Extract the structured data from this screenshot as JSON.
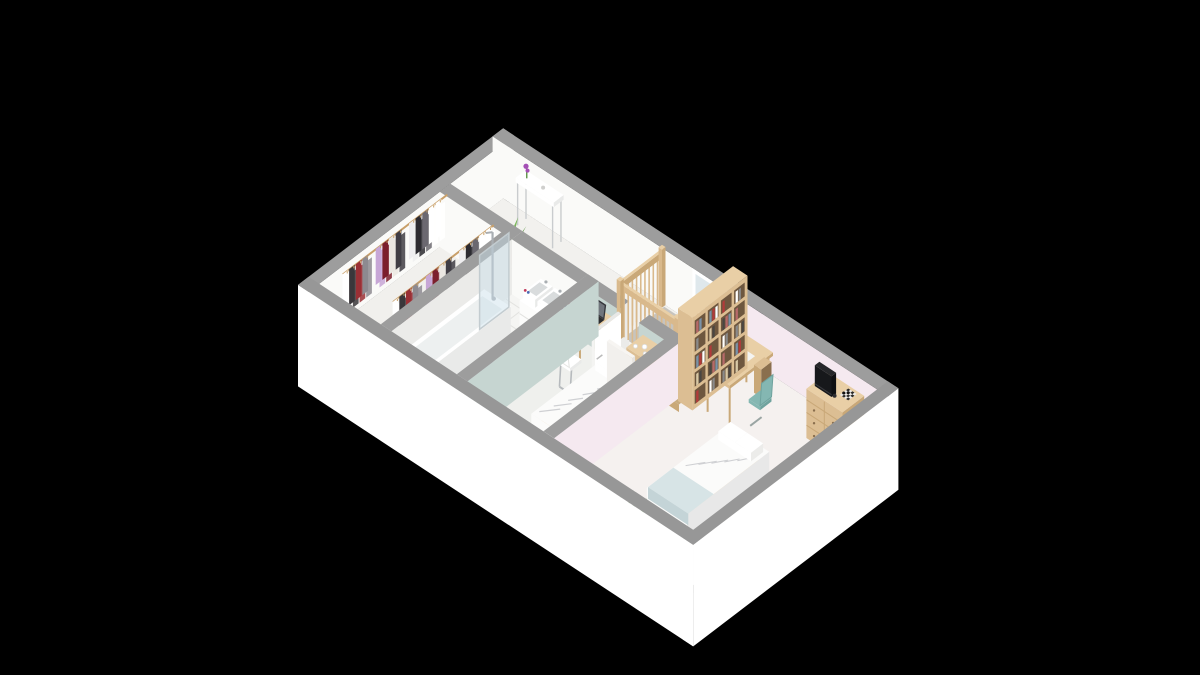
{
  "scene": {
    "kind": "3d-floorplan-isometric-render",
    "background": "#000000",
    "floor_count": 1,
    "rooms": [
      {
        "key": "walk-in-closet",
        "furniture": [
          "clothes-rack-row-1",
          "clothes-rack-row-2"
        ]
      },
      {
        "key": "bathroom",
        "furniture": [
          "bathtub",
          "shower-glass-screen",
          "shower-column",
          "double-sink-vanity",
          "toiletry-bottles",
          "bath-mat",
          "wood-stool"
        ]
      },
      {
        "key": "hallway-landing",
        "furniture": [
          "console-table",
          "orchid-flower",
          "potted-plant-large",
          "potted-plant-small",
          "stair-void",
          "stair-railing",
          "stair-steps",
          "window"
        ]
      },
      {
        "key": "bedroom-small",
        "furniture": [
          "desk-with-laptop",
          "white-cantilever-chair",
          "chest-of-drawers",
          "nightstand-with-lamp",
          "single-bed",
          "open-door"
        ]
      },
      {
        "key": "bedroom-large",
        "furniture": [
          "bookshelf",
          "study-desk",
          "teal-chair",
          "dresser-with-tv",
          "chessboard",
          "double-bed",
          "corner-plants",
          "open-door"
        ]
      }
    ]
  },
  "colors": {
    "background": "#000000",
    "wall_top": "#9d9d9d",
    "wall_top_front": "#979797",
    "wall_inner": "#fafaf8",
    "wall_inner_shade": "#ebebe9",
    "wall_outer": "#ffffff",
    "sage": "#c6d5d1",
    "sage_shade": "#b7c9c5",
    "pink": "#f5e9f0",
    "floor": "#f0efec",
    "floor_closet": "#f1f0ed",
    "floor_bath": "#f5f5f3",
    "tile_line": "#e3e3e0",
    "floor_bed1": "#eff0ed",
    "floor_bed2": "#f5f1ef",
    "floor_hall": "#f2f1ee",
    "void_hole": "#c7c4be",
    "void_shadow": "#b2afa9",
    "step_wood": [
      "#ecd6ac",
      "#e5cda1",
      "#dcc296",
      "#d2b78b",
      "#c7ab7f"
    ],
    "wood": "#dcbe93",
    "wood_side": "#c9a878",
    "wood_top": "#e9cfa6",
    "wood_dark": "#8a6f4e",
    "shelf_inset": "#6e573f",
    "rail_wood": "#d9b98c",
    "white_furn": "#fcfcfb",
    "white_furn_shade": "#e9eae9",
    "tub_inner": "#edf0f0",
    "basin_inner": "#d9dcdd",
    "glass": "rgba(200,222,232,0.45)",
    "glass_frame": "#c3ccd0",
    "chrome": "#a9aeb2",
    "mat": "#b3a4b9",
    "mat_edge": "#c4b6c8",
    "duvet": "#fbfbfa",
    "duvet_shade": "#e8e8e8",
    "duvet_pattern": "#cfd0d3",
    "throw_blue": "#d7e4e6",
    "throw_blue_side": "#c4d4d7",
    "pillow": "#ffffff",
    "lamp": "#f7f6f2",
    "tv_body": "#222326",
    "tv_screen": "#17181b",
    "teal_chair": "#84b7b2",
    "teal_chair_side": "#6fa39e",
    "plant_green": "#5b9243",
    "plant_dark": "#39702e",
    "plant_light": "#7ab65a",
    "pot_terracotta": "#b2603c",
    "flower_purple": "#a44fb5",
    "metal_leg": "#c9ccce",
    "laptop_dark": "#2c2c2e",
    "laptop_screen": "#70757c",
    "clothes": [
      "#ffffff",
      "#3a373b",
      "#9a2f35",
      "#8d8a90",
      "#54515a",
      "#c7a6d6",
      "#7c1f2c",
      "#ebe7e2",
      "#403d44",
      "#b23440",
      "#efeef0",
      "#2d2b31",
      "#6b6870",
      "#ffffff"
    ],
    "books": [
      "#b23a3a",
      "#ffffff",
      "#8a8a8a",
      "#d8c8a6",
      "#4a4642",
      "#b76a6a",
      "#7a92a8"
    ],
    "toiletries": [
      "#c2385a",
      "#4a6ab2",
      "#8e3fa0"
    ],
    "check_dark": "#2a2a2a",
    "check_light": "#ededed"
  }
}
